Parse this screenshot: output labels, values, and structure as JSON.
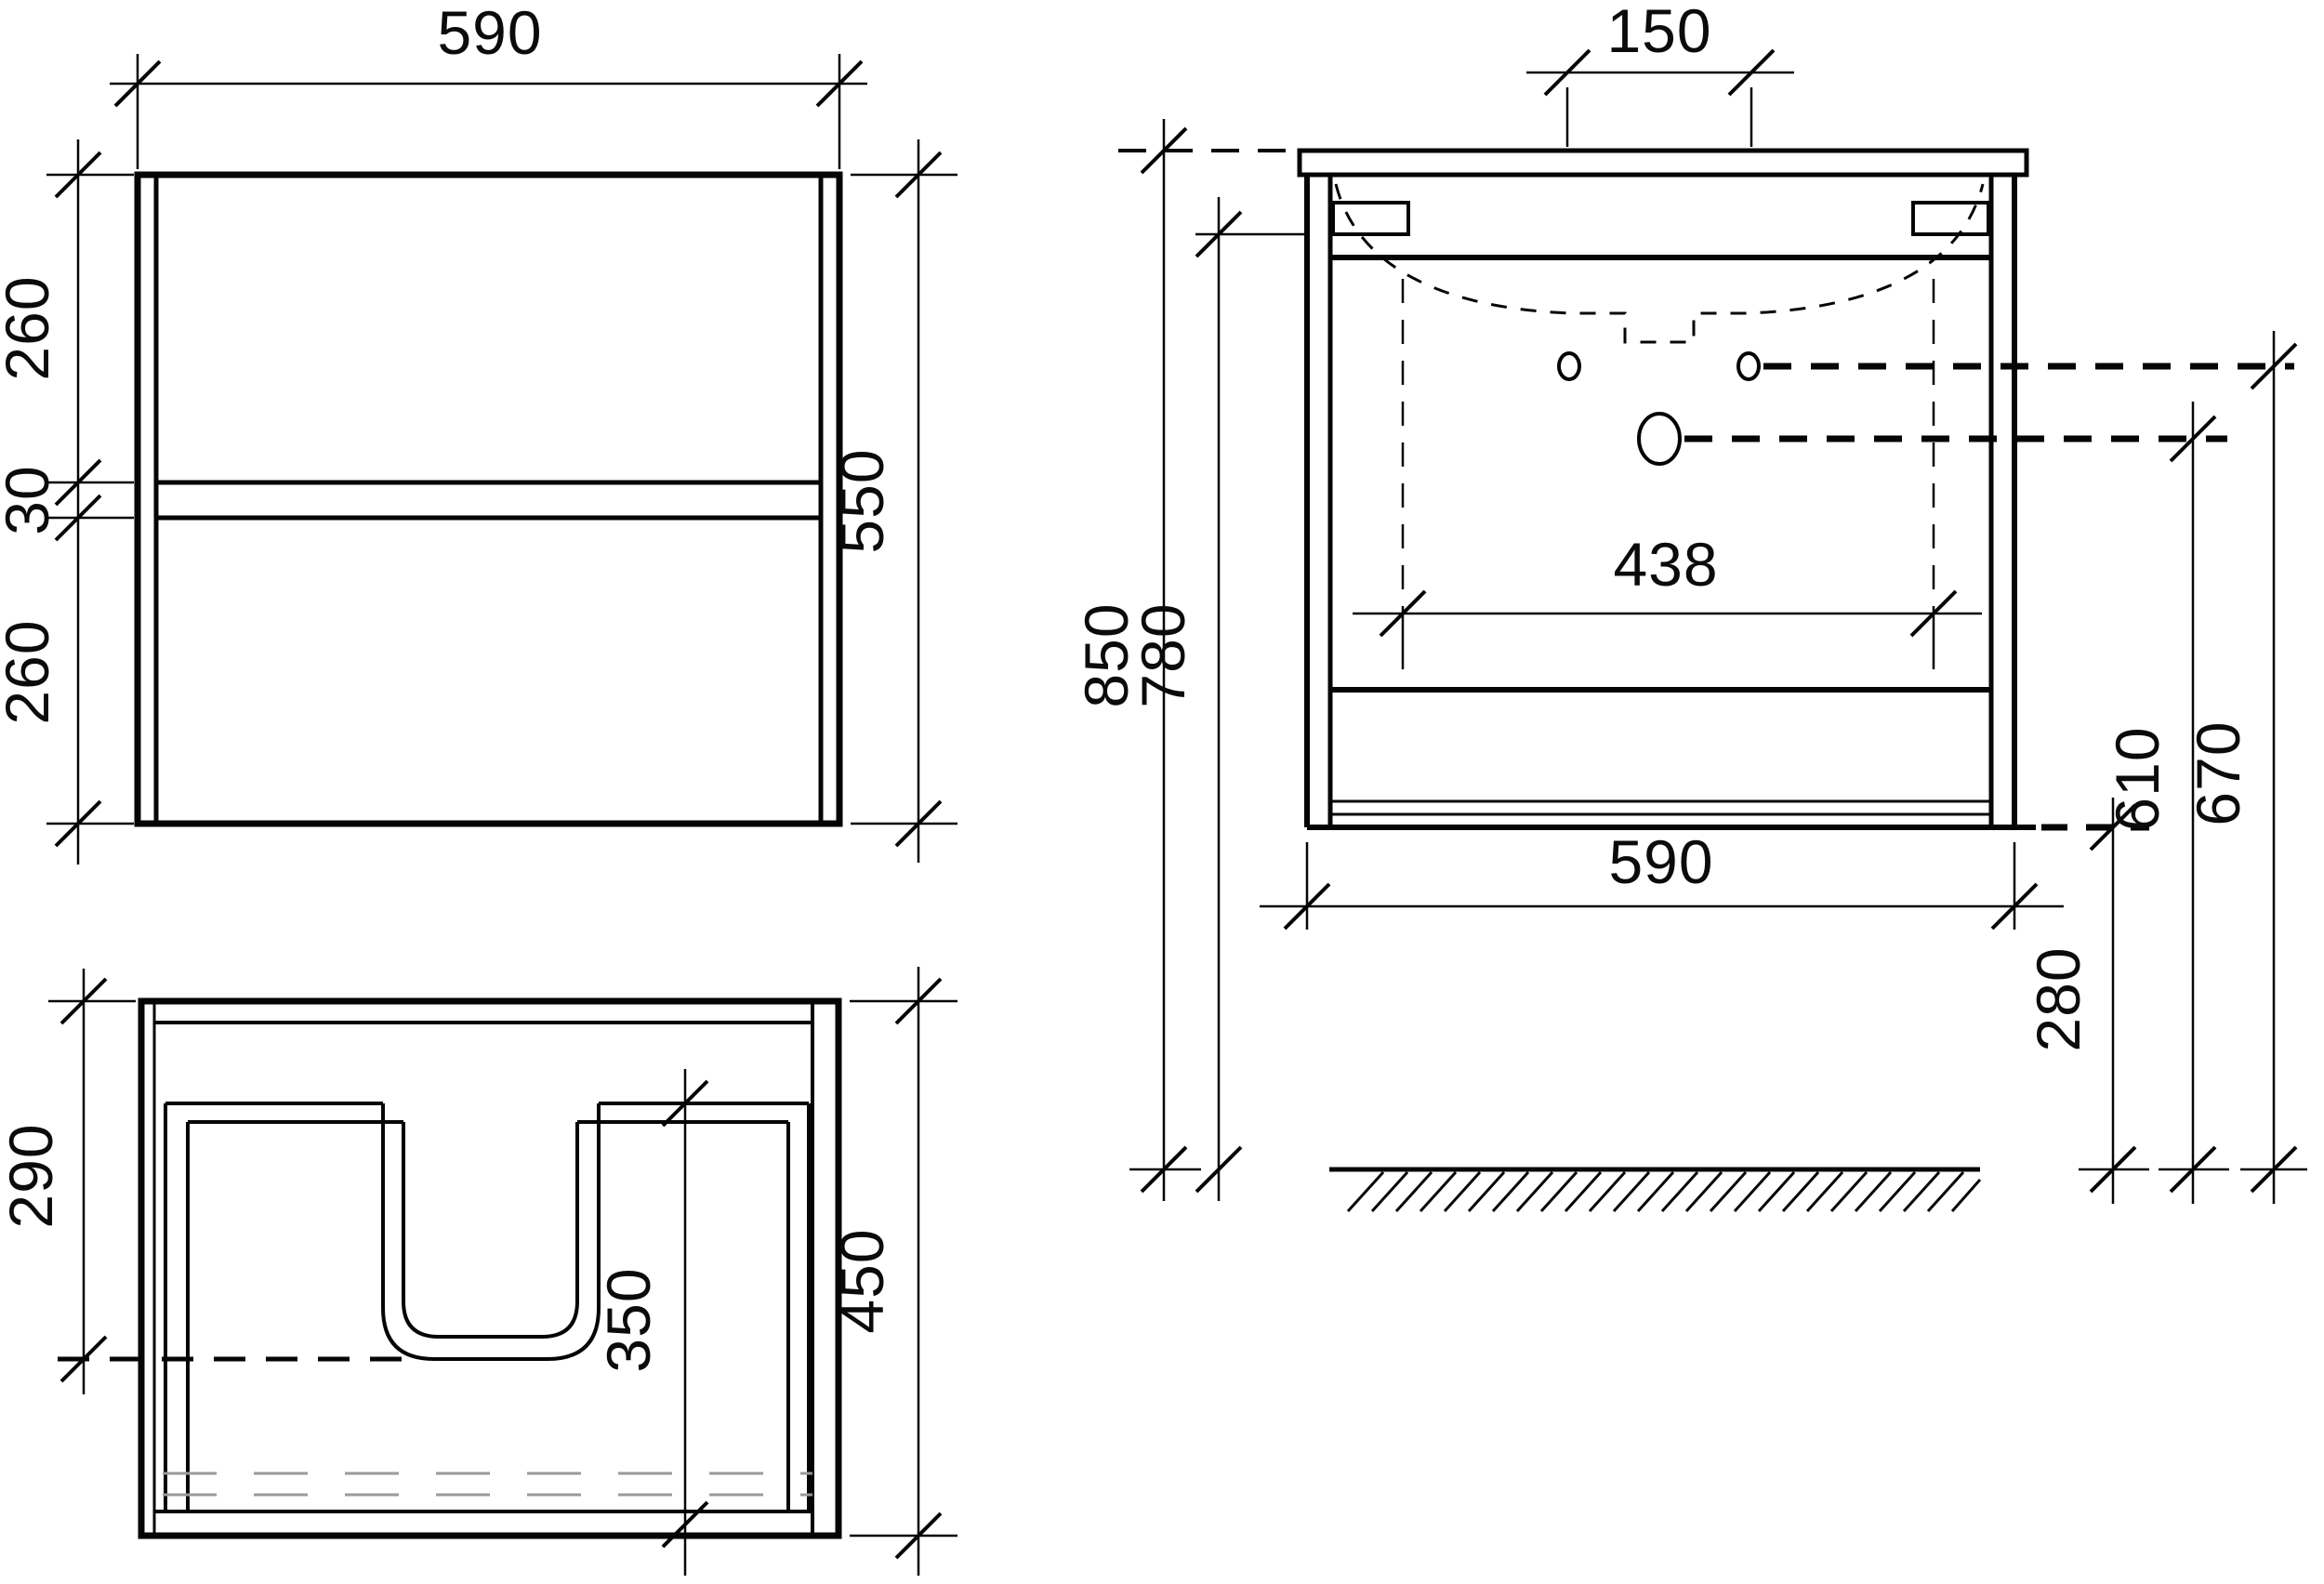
{
  "drawing": {
    "type": "furniture-technical-drawing",
    "subject": "wall-hung vanity cabinet with washbasin, three orthographic views",
    "units": "mm",
    "colors": {
      "line": "#050505",
      "gray_dash": "#9a9a9a",
      "background": "#ffffff"
    },
    "front_view": {
      "width_top": "590",
      "left_chain_top": "260",
      "left_chain_mid": "30",
      "left_chain_bottom": "260",
      "height_right": "550"
    },
    "plan_view": {
      "depth_to_cutout_left": "290",
      "cutout_depth_inner": "350",
      "depth_right": "450"
    },
    "elevation_view": {
      "tap_hole_spacing_top": "150",
      "bracket_spacing": "438",
      "width_bottom": "590",
      "total_height_left": "850",
      "under_top_height_left": "780",
      "drain_height_right": "610",
      "tap_holes_height_right": "670",
      "floor_clearance_right": "280"
    }
  }
}
